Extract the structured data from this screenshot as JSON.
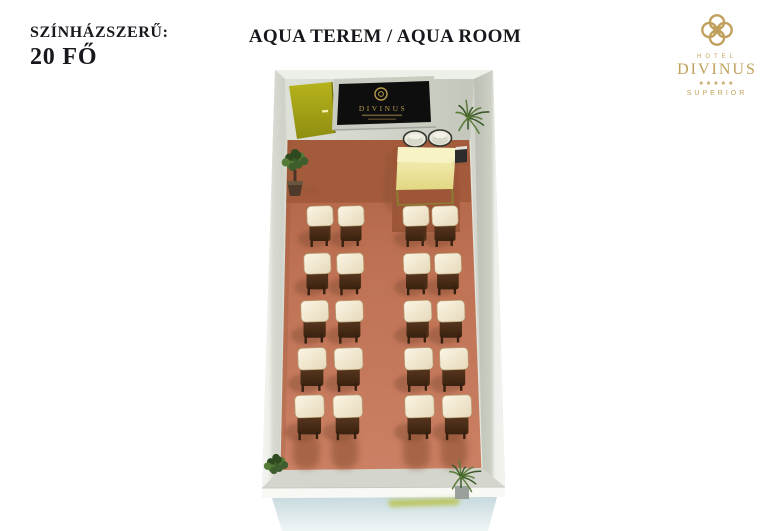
{
  "header": {
    "arrangement_label": "SZÍNHÁZSZERŰ:",
    "capacity": "20 FŐ",
    "title": "AQUA TEREM / AQUA ROOM"
  },
  "logo": {
    "hotel": "HOTEL",
    "name": "DIVINUS",
    "stars": "★★★★★",
    "tier": "SUPERIOR",
    "color": "#c0a05c"
  },
  "screen": {
    "label": "DIVINUS"
  },
  "room": {
    "layout": {
      "type": "theater",
      "total_seats": 20,
      "rows": 5,
      "seats_per_row": 4,
      "left_block_cols": 2,
      "right_block_cols": 2,
      "aisle": true
    },
    "features": [
      "entrance-door",
      "presentation-screen",
      "presenter-table",
      "2 presenter chairs",
      "av-equipment",
      "4 plants"
    ],
    "colors": {
      "walls": "#d4d6ce",
      "floor": "#c0714f",
      "floor_dark": "#a45b3c",
      "door": "#a9a715",
      "table": "#efe59c",
      "chair_seat": "#f4ecd6",
      "chair_frame": "#4e2c17",
      "front_exterior": "#cfdfe4",
      "shadow": "#7d4830"
    }
  }
}
